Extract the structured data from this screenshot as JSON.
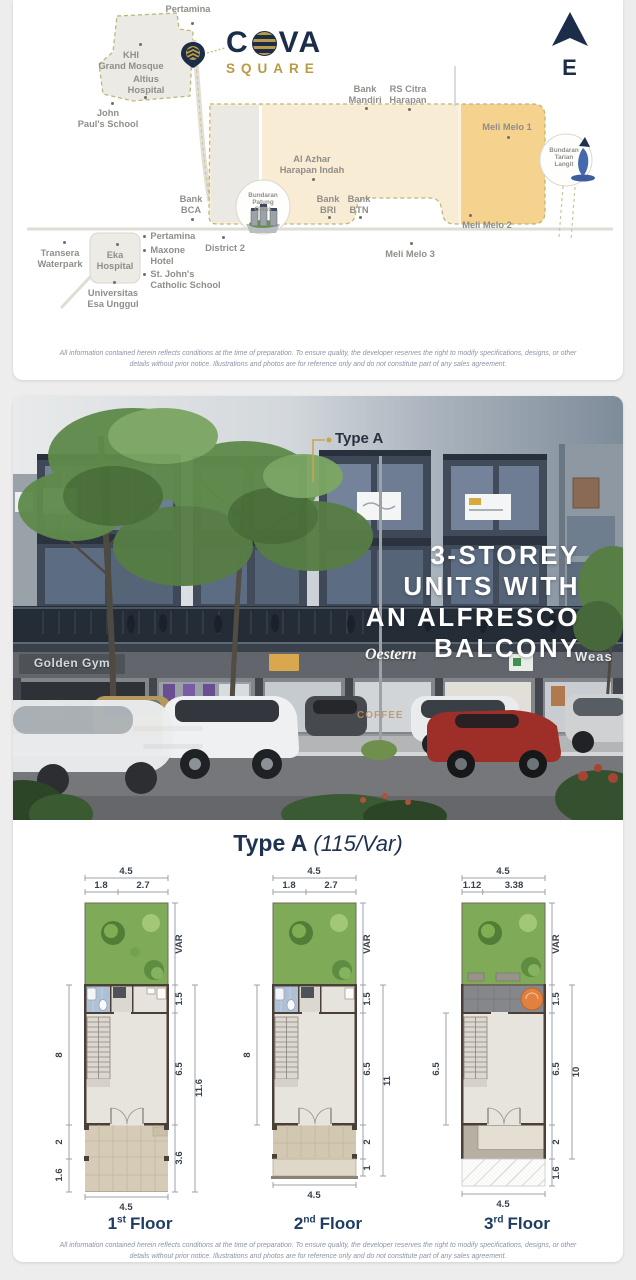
{
  "page": {
    "disclaimer": "All information contained herein reflects conditions at the time of preparation. To ensure quality, the developer reserves the right to modify specifications, designs, or other details without prior notice. Illustrations and photos are for reference only and do not constitute part of any sales agreement."
  },
  "colors": {
    "brand_navy": "#1C2D49",
    "brand_gold": "#B99A45",
    "map_beige": "#F8ECD4",
    "map_orange": "#F5D28E",
    "garden_green": "#7FAB58"
  },
  "map": {
    "compass_label": "E",
    "logo": {
      "part1": "C",
      "part2": "VA",
      "sub": "SQUARE"
    },
    "labels": {
      "pertamina_top": "Pertamina",
      "khi": "KHI\nGrand Mosque",
      "altius": "Altius\nHospital",
      "john_pauls": "John\nPaul's School",
      "bank_mandiri": "Bank\nMandiri",
      "rs_citra": "RS Citra\nHarapan",
      "meli1": "Meli Melo 1",
      "al_azhar": "Al Azhar\nHarapan Indah",
      "bank_bca": "Bank\nBCA",
      "bank_bri": "Bank\nBRI",
      "bank_btn": "Bank\nBTN",
      "meli2": "Meli Melo 2",
      "meli3": "Meli Melo 3",
      "bundaran_patung": "Bundaran\nPatung\nGelas",
      "bundaran_tarian": "Bundaran\nTarian\nLangit",
      "district2": "District 2",
      "transera": "Transera\nWaterpark",
      "eka": "Eka\nHospital",
      "pertamina2": "Pertamina",
      "maxone": "Maxone\nHotel",
      "st_johns": "St. John's\nCatholic School",
      "universitas": "Universitas\nEsa Unggul"
    }
  },
  "photo": {
    "callout": "Type A",
    "headline": "3-STOREY\nUNITS WITH\nAN ALFRESCO\nBALCONY",
    "signs": {
      "gym": "Golden Gym",
      "oestern": "Oestern",
      "weas": "Weas",
      "coffee": "COFFEE"
    }
  },
  "floorplans": {
    "title": "Type A",
    "spec": "(115/Var)",
    "plans": [
      {
        "num": "1",
        "ord": "st",
        "word": "Floor",
        "top_total": "4.5",
        "top_a": "1.8",
        "top_b": "2.7",
        "side_var": "VAR",
        "side_15": "1.5",
        "side_65": "6.5",
        "right_total": "11.6",
        "right_low": "3.6",
        "left_main": "8",
        "left_low_a": "2",
        "left_low_b": "1.6",
        "bottom": "4.5"
      },
      {
        "num": "2",
        "ord": "nd",
        "word": "Floor",
        "top_total": "4.5",
        "top_a": "1.8",
        "top_b": "2.7",
        "side_var": "VAR",
        "side_15": "1.5",
        "side_65": "6.5",
        "right_total": "11",
        "right_low_a": "2",
        "right_low_b": "1",
        "left_main": "8",
        "bottom": "4.5"
      },
      {
        "num": "3",
        "ord": "rd",
        "word": "Floor",
        "top_total": "4.5",
        "top_a": "1.12",
        "top_b": "3.38",
        "side_var": "VAR",
        "side_15": "1.5",
        "side_65": "6.5",
        "right_total": "10",
        "right_low_a": "2",
        "right_low_b": "1.6",
        "left_main": "6.5",
        "bottom": "4.5"
      }
    ]
  }
}
